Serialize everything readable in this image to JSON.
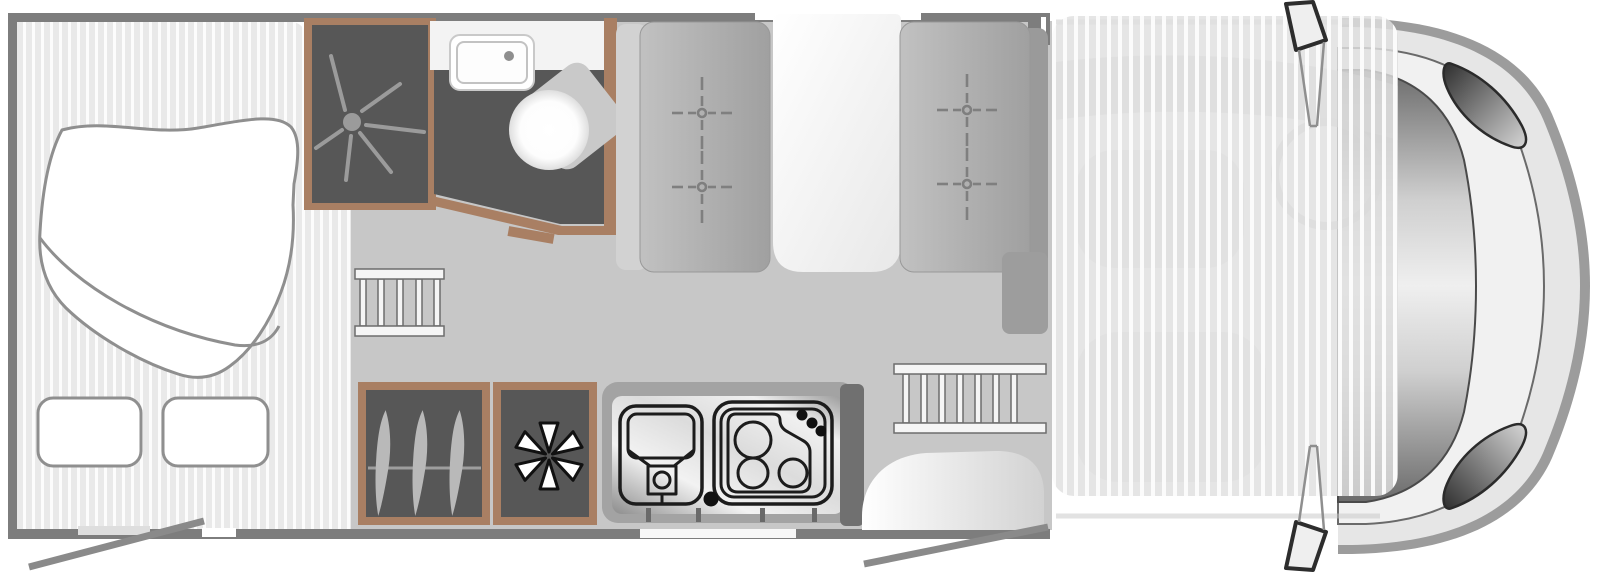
{
  "page": {
    "background": "#ffffff",
    "width": 1598,
    "height": 572
  },
  "floorplan": {
    "kind": "motorhome top-view floor plan",
    "orientation": "driver cab on the right, habitation area on the left",
    "areas": [
      {
        "id": "bedroom",
        "label": "rear bedroom with double bed, duvet and two pillows"
      },
      {
        "id": "shower",
        "label": "shower cubicle with drain"
      },
      {
        "id": "washroom",
        "label": "washroom with counter basin and swivel toilet"
      },
      {
        "id": "dinette",
        "label": "dinette with two facing bench seats and white table"
      },
      {
        "id": "wardrobe",
        "label": "wardrobe with clothes rail and three hangers"
      },
      {
        "id": "fridge",
        "label": "refrigerator compartment with snowflake symbol"
      },
      {
        "id": "kitchen",
        "label": "kitchen block with sink and three-burner hob"
      },
      {
        "id": "entrance",
        "label": "habitation entry step with open door"
      },
      {
        "id": "cab",
        "label": "driver cab covered by translucent drop-down bed overlay"
      },
      {
        "id": "ladders",
        "label": "two bunk ladders"
      }
    ],
    "icons": [
      {
        "name": "shower-drain-icon",
        "count": 1
      },
      {
        "name": "basin-icon",
        "count": 1
      },
      {
        "name": "toilet-icon",
        "count": 1
      },
      {
        "name": "seat-anchor-icon",
        "count": 4
      },
      {
        "name": "hanger-icon",
        "count": 3
      },
      {
        "name": "snowflake-icon",
        "count": 1
      },
      {
        "name": "kitchen-sink-icon",
        "count": 1
      },
      {
        "name": "hob-burners-icon",
        "burners": 3,
        "knobs": 3
      },
      {
        "name": "ladder-icon",
        "count": 2
      },
      {
        "name": "door-swing-icon",
        "count": 2
      },
      {
        "name": "wing-mirror-icon",
        "count": 2
      }
    ],
    "colors": {
      "wall": "#7d7d7d",
      "wood": "#a97f63",
      "dark_floor": "#575757",
      "corridor_floor": "#c7c7c7",
      "bedroom_floor": "#ebebeb",
      "bench": "#ababab",
      "cabinet": "#9d9d9d",
      "symbol": "#9b9b9b",
      "door_line": "#8a8a8a",
      "cab_body": "#e6e6e6",
      "cab_rim": "#9c9c9c",
      "white": "#ffffff",
      "outline": "#1c1c1c"
    }
  }
}
